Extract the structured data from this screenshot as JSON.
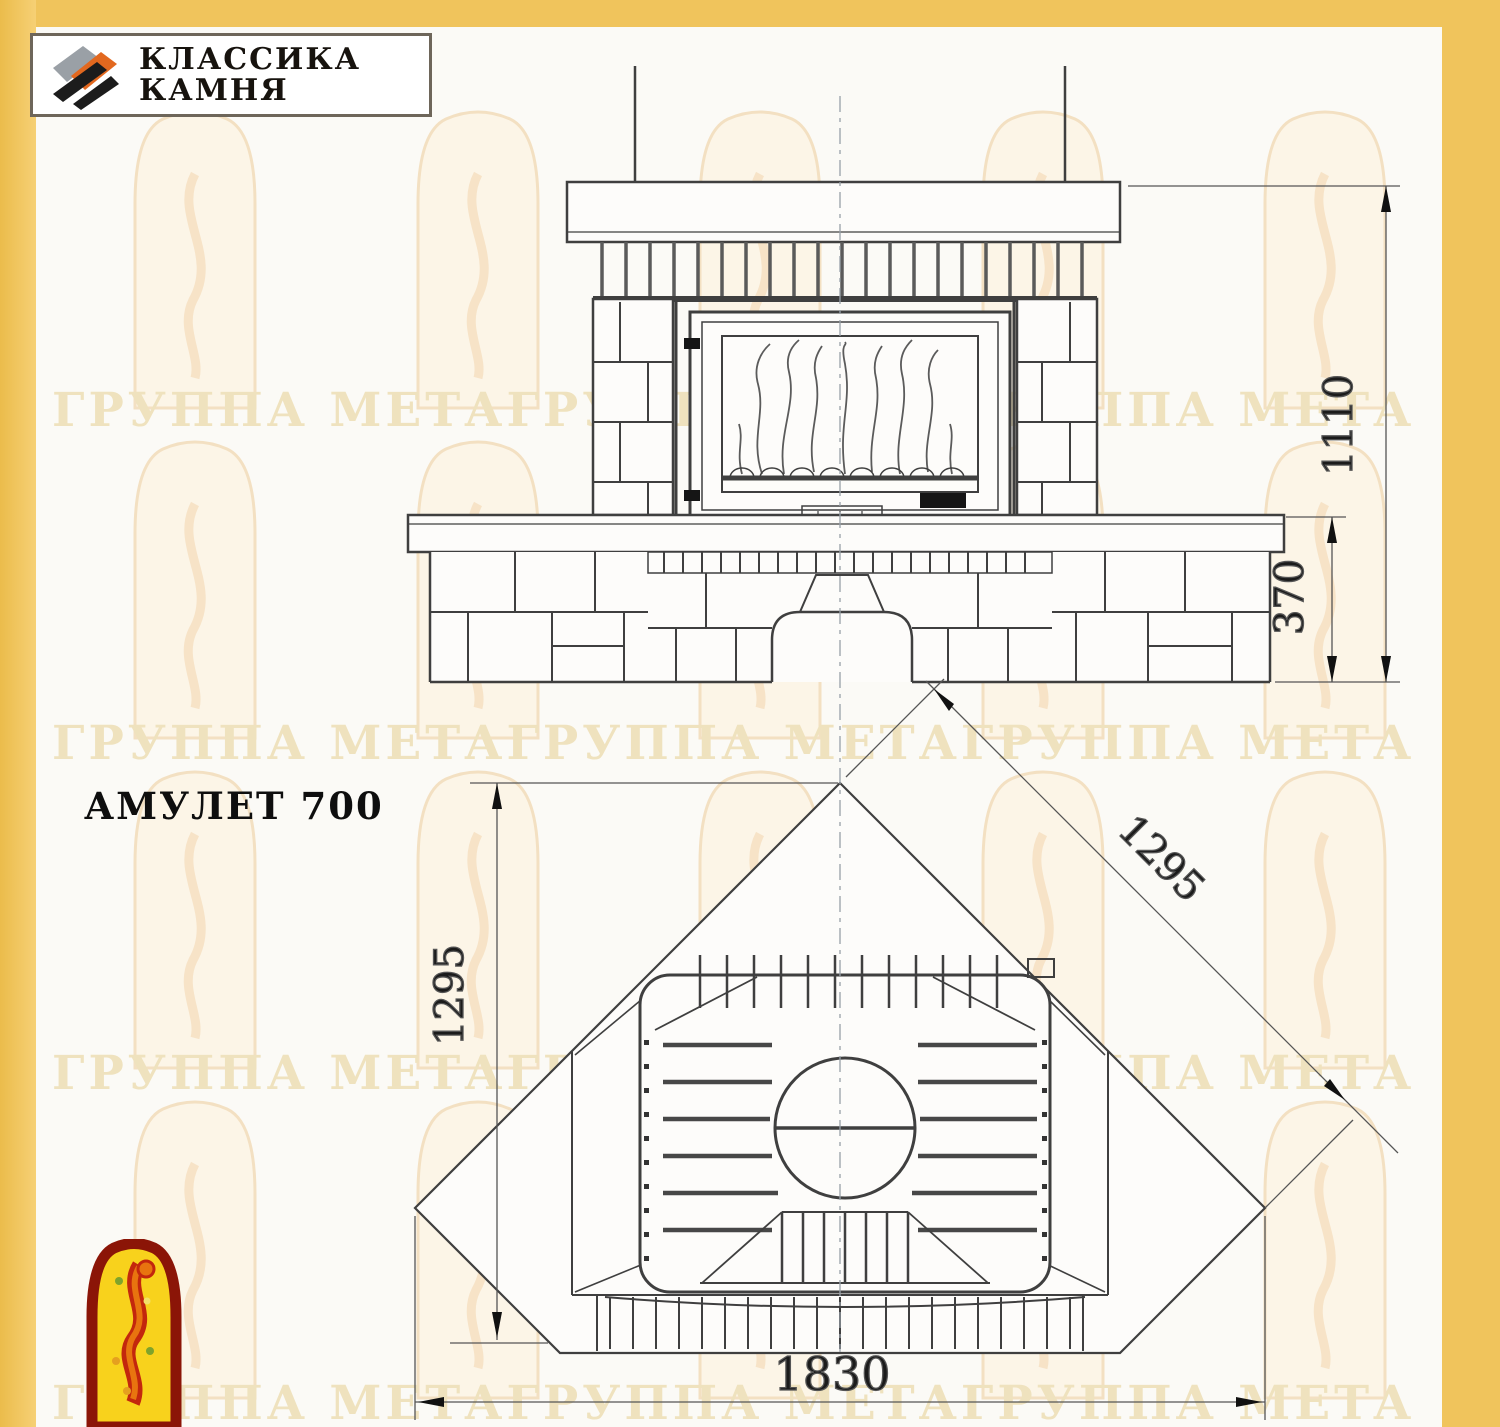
{
  "page": {
    "background": "#FBFAF6",
    "accent_yellow": "#F0C45C",
    "drawing_line_color": "#3F3F3F",
    "dimension_color": "#4A4A4A",
    "watermark_color": "#EFE2BE"
  },
  "logo_box": {
    "line1": "КЛАССИКА",
    "line2": "КАМНЯ",
    "icon": "stone-slabs-icon",
    "icon_colors": {
      "gray": "#9AA0A6",
      "orange": "#E2681F",
      "black": "#1C1C1C"
    }
  },
  "product": {
    "name": "АМУЛЕТ 700"
  },
  "watermark": {
    "text": "ГРУППА МЕТАГРУППА МЕТАГРУППА МЕТА"
  },
  "front_view": {
    "description": "front elevation of stone fireplace",
    "dim_total_height": "1110",
    "dim_bench_height": "370"
  },
  "plan_view": {
    "description": "corner installation plan of fireplace",
    "dim_depth": "1295",
    "dim_side": "1295",
    "dim_width": "1830"
  },
  "footer_logo": {
    "name": "jester-arch-logo",
    "border": "#8B1507",
    "fill": "#F8D21C",
    "figure": "#D2340F"
  }
}
